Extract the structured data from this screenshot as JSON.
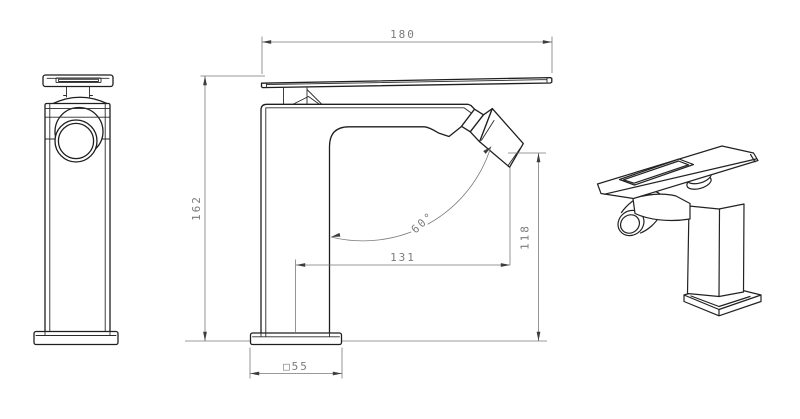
{
  "colors": {
    "background": "#ffffff",
    "object_line": "#1f1f1f",
    "dimension_line": "#7a7a7a",
    "dimension_text": "#7b7b7b"
  },
  "views": {
    "side": {
      "dimensions": {
        "total_length": "180",
        "body_height": "162",
        "spout_reach": "131",
        "outlet_height": "118",
        "outlet_angle": "60°",
        "base_size": "□55"
      }
    }
  }
}
